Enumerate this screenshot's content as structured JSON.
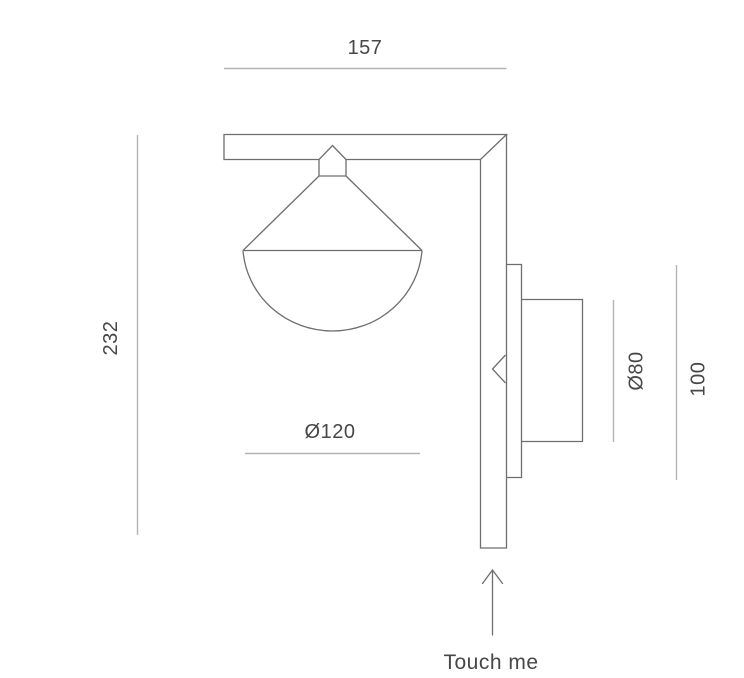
{
  "diagram": {
    "type": "technical-drawing",
    "subject": "wall-lamp-side-view",
    "dimensions": [
      {
        "id": "width",
        "label": "157",
        "orientation": "horizontal"
      },
      {
        "id": "height",
        "label": "232",
        "orientation": "vertical"
      },
      {
        "id": "shade-diameter",
        "label": "Ø120",
        "orientation": "horizontal"
      },
      {
        "id": "driver-diameter",
        "label": "Ø80",
        "orientation": "vertical"
      },
      {
        "id": "backplate-height",
        "label": "100",
        "orientation": "vertical"
      }
    ],
    "annotations": [
      {
        "id": "touch",
        "label": "Touch me"
      }
    ],
    "colors": {
      "background": "#ffffff",
      "outline": "#6e6e6e",
      "dimension_line": "#b3b3b3",
      "text": "#474747"
    }
  }
}
